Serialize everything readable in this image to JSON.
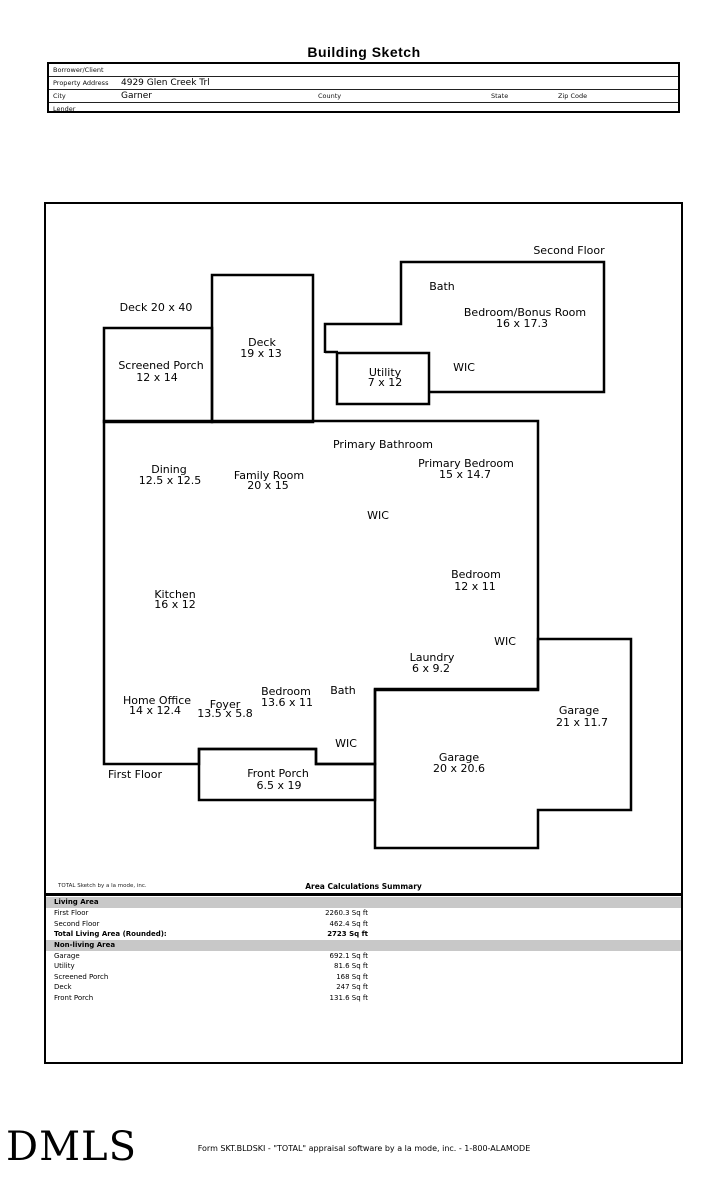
{
  "page": {
    "title": "Building Sketch"
  },
  "form": {
    "borrower_label": "Borrower/Client",
    "property_label": "Property Address",
    "property_value": "4929 Glen Creek Trl",
    "city_label": "City",
    "city_value": "Garner",
    "county_label": "County",
    "state_label": "State",
    "zip_label": "Zip Code",
    "lender_label": "Lender"
  },
  "sketch": {
    "labels": [
      {
        "text": "Second Floor",
        "x": 523,
        "y": 47
      },
      {
        "text": "Bath",
        "x": 396,
        "y": 83
      },
      {
        "text": "Bedroom/Bonus Room",
        "x": 479,
        "y": 109
      },
      {
        "text": "16 x 17.3",
        "x": 476,
        "y": 120
      },
      {
        "text": "WIC",
        "x": 418,
        "y": 164
      },
      {
        "text": "Utility",
        "x": 339,
        "y": 169
      },
      {
        "text": "7 x 12",
        "x": 339,
        "y": 179
      },
      {
        "text": "Deck 20 x 40",
        "x": 110,
        "y": 104
      },
      {
        "text": "Screened Porch",
        "x": 115,
        "y": 162
      },
      {
        "text": "12 x 14",
        "x": 111,
        "y": 174
      },
      {
        "text": "Deck",
        "x": 216,
        "y": 139
      },
      {
        "text": "19 x 13",
        "x": 215,
        "y": 150
      },
      {
        "text": "Primary Bathroom",
        "x": 337,
        "y": 241
      },
      {
        "text": "Dining",
        "x": 123,
        "y": 266
      },
      {
        "text": "12.5 x 12.5",
        "x": 124,
        "y": 277
      },
      {
        "text": "Family Room",
        "x": 223,
        "y": 272
      },
      {
        "text": "20 x 15",
        "x": 222,
        "y": 282
      },
      {
        "text": "Primary Bedroom",
        "x": 420,
        "y": 260
      },
      {
        "text": "15 x 14.7",
        "x": 419,
        "y": 271
      },
      {
        "text": "WIC",
        "x": 332,
        "y": 312
      },
      {
        "text": "Bedroom",
        "x": 430,
        "y": 371
      },
      {
        "text": "12 x 11",
        "x": 429,
        "y": 383
      },
      {
        "text": "Kitchen",
        "x": 129,
        "y": 391
      },
      {
        "text": "16 x 12",
        "x": 129,
        "y": 401
      },
      {
        "text": "WIC",
        "x": 459,
        "y": 438
      },
      {
        "text": "Laundry",
        "x": 386,
        "y": 454
      },
      {
        "text": "6 x 9.2",
        "x": 385,
        "y": 465
      },
      {
        "text": "Home Office",
        "x": 111,
        "y": 497
      },
      {
        "text": "14 x 12.4",
        "x": 109,
        "y": 507
      },
      {
        "text": "Foyer",
        "x": 179,
        "y": 501
      },
      {
        "text": "13.5 x 5.8",
        "x": 179,
        "y": 510
      },
      {
        "text": "Bedroom",
        "x": 240,
        "y": 488
      },
      {
        "text": "13.6 x 11",
        "x": 241,
        "y": 499
      },
      {
        "text": "Bath",
        "x": 297,
        "y": 487
      },
      {
        "text": "WIC",
        "x": 300,
        "y": 540
      },
      {
        "text": "First Floor",
        "x": 89,
        "y": 571
      },
      {
        "text": "Front Porch",
        "x": 232,
        "y": 570
      },
      {
        "text": "6.5 x 19",
        "x": 233,
        "y": 582
      },
      {
        "text": "Garage",
        "x": 413,
        "y": 554
      },
      {
        "text": "20 x 20.6",
        "x": 413,
        "y": 565
      },
      {
        "text": "Garage",
        "x": 533,
        "y": 507
      },
      {
        "text": "21 x 11.7",
        "x": 536,
        "y": 519
      }
    ]
  },
  "area_summary": {
    "credit": "TOTAL Sketch by a la mode, inc.",
    "title": "Area Calculations Summary",
    "rows": [
      {
        "type": "band",
        "label": "Living Area"
      },
      {
        "type": "row",
        "label": "First Floor",
        "value": "2260.3 Sq ft"
      },
      {
        "type": "row",
        "label": "Second Floor",
        "value": "462.4 Sq ft"
      },
      {
        "type": "total",
        "label": "Total Living Area (Rounded):",
        "value": "2723 Sq ft"
      },
      {
        "type": "band",
        "label": "Non-living Area"
      },
      {
        "type": "row",
        "label": "Garage",
        "value": "692.1 Sq ft"
      },
      {
        "type": "row",
        "label": "Utility",
        "value": "81.6 Sq ft"
      },
      {
        "type": "row",
        "label": "Screened Porch",
        "value": "168 Sq ft"
      },
      {
        "type": "row",
        "label": "Deck",
        "value": "247 Sq ft"
      },
      {
        "type": "row",
        "label": "Front Porch",
        "value": "131.6 Sq ft"
      }
    ]
  },
  "footer": {
    "logo": "DMLS",
    "text": "Form SKT.BLDSKI - \"TOTAL\" appraisal software by a la mode, inc. - 1-800-ALAMODE"
  }
}
